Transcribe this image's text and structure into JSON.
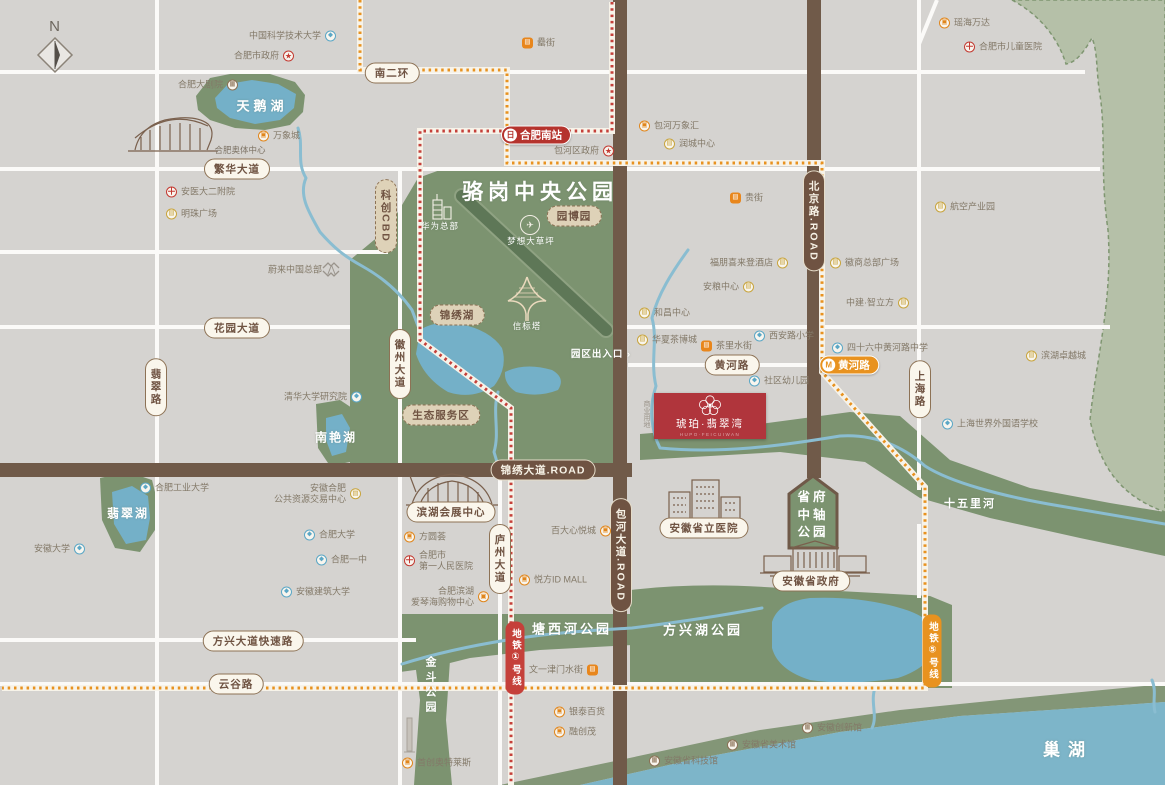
{
  "colors": {
    "background": "#d5d3d0",
    "park_green": "#7c9370",
    "light_green": "#b5c0a8",
    "water_blue": "#74b0c8",
    "river_blue": "#8abdd1",
    "road_brown": "#705a49",
    "metro_line1_red": "#c5403a",
    "metro_line5_orange": "#e8921f",
    "project_red": "#b0353c",
    "station_red": "#b5332d"
  },
  "compass": {
    "label": "N"
  },
  "project": {
    "name": "琥珀·翡翠湾",
    "subtitle": "HUPO·FEICUIWAN"
  },
  "axis_park": {
    "lines": [
      "省府",
      "中轴",
      "公园"
    ]
  },
  "area_labels": [
    {
      "text": "骆岗中央公园",
      "x": 540,
      "y": 191,
      "size": 21,
      "bold": 1,
      "ls": 5
    },
    {
      "text": "园区出入口 ›",
      "x": 601,
      "y": 353,
      "size": 9.5,
      "bold": 1,
      "ls": 1
    },
    {
      "text": "华为总部",
      "x": 440,
      "y": 226,
      "size": 8.5,
      "ls": 1
    },
    {
      "text": "梦想大草坪",
      "x": 531,
      "y": 241,
      "size": 8.5,
      "ls": 1
    },
    {
      "text": "信标塔",
      "x": 527,
      "y": 326,
      "size": 8.5,
      "ls": 1
    },
    {
      "text": "天鹅湖",
      "x": 262,
      "y": 105,
      "size": 13,
      "bold": 1,
      "ls": 4
    },
    {
      "text": "翡翠湖",
      "x": 128,
      "y": 513,
      "size": 12,
      "bold": 1,
      "ls": 2
    },
    {
      "text": "南艳湖",
      "x": 336,
      "y": 437,
      "size": 12,
      "bold": 1,
      "ls": 2
    },
    {
      "text": "金斗公园",
      "x": 430,
      "y": 686,
      "size": 11,
      "bold": 1,
      "ls": 4,
      "vertical": 1
    },
    {
      "text": "塘西河公园",
      "x": 572,
      "y": 628,
      "size": 13,
      "bold": 1,
      "ls": 3
    },
    {
      "text": "方兴湖公园",
      "x": 703,
      "y": 629,
      "size": 13,
      "bold": 1,
      "ls": 3
    },
    {
      "text": "十五里河",
      "x": 970,
      "y": 503,
      "size": 11,
      "bold": 1,
      "ls": 2
    },
    {
      "text": "巢湖",
      "x": 1068,
      "y": 748,
      "size": 17,
      "bold": 1,
      "ls": 8
    },
    {
      "text": "合肥奥体中心",
      "x": 240,
      "y": 150,
      "size": 8.5,
      "color": "#7d7365"
    },
    {
      "text": "商业用地",
      "x": 646,
      "y": 414,
      "size": 7,
      "color": "#9b948a",
      "vertical": 1
    }
  ],
  "pills": [
    {
      "text": "南二环",
      "x": 392,
      "y": 73,
      "style": "cream"
    },
    {
      "text": "繁华大道",
      "x": 237,
      "y": 169,
      "style": "cream"
    },
    {
      "text": "花园大道",
      "x": 237,
      "y": 328,
      "style": "cream"
    },
    {
      "text": "翡翠路",
      "x": 156,
      "y": 387,
      "style": "cream",
      "vertical": 1
    },
    {
      "text": "徽州大道",
      "x": 400,
      "y": 364,
      "style": "cream",
      "vertical": 1
    },
    {
      "text": "黄河路",
      "x": 732,
      "y": 365,
      "style": "cream"
    },
    {
      "text": "上海路",
      "x": 920,
      "y": 389,
      "style": "cream",
      "vertical": 1
    },
    {
      "text": "庐州大道",
      "x": 500,
      "y": 559,
      "style": "cream",
      "vertical": 1
    },
    {
      "text": "方兴大道快速路",
      "x": 253,
      "y": 641,
      "style": "cream"
    },
    {
      "text": "云谷路",
      "x": 236,
      "y": 684,
      "style": "cream"
    },
    {
      "text": "滨湖会展中心",
      "x": 451,
      "y": 512,
      "style": "cream"
    },
    {
      "text": "安徽省立医院",
      "x": 704,
      "y": 528,
      "style": "cream"
    },
    {
      "text": "安徽省政府",
      "x": 811,
      "y": 581,
      "style": "cream"
    },
    {
      "text": "锦绣大道.ROAD",
      "x": 543,
      "y": 470,
      "style": "brown"
    },
    {
      "text": "北京路.ROAD",
      "x": 814,
      "y": 221,
      "style": "brown",
      "vertical": 1
    },
    {
      "text": "包河大道.ROAD",
      "x": 621,
      "y": 555,
      "style": "brown",
      "vertical": 1
    },
    {
      "text": "科创CBD",
      "x": 386,
      "y": 216,
      "style": "tan",
      "vertical": 1
    },
    {
      "text": "园博园",
      "x": 574,
      "y": 216,
      "style": "tan"
    },
    {
      "text": "锦绣湖",
      "x": 457,
      "y": 315,
      "style": "tan"
    },
    {
      "text": "生态服务区",
      "x": 441,
      "y": 415,
      "style": "tan"
    }
  ],
  "stations": [
    {
      "name": "合肥南站",
      "x": 536,
      "y": 135,
      "color": "red",
      "glyph": "日"
    },
    {
      "name": "黄河路",
      "x": 849,
      "y": 365,
      "color": "orange",
      "glyph": "M"
    }
  ],
  "metro_tags": [
    {
      "name": "地铁①号线",
      "x": 515,
      "y": 658,
      "color": "red"
    },
    {
      "name": "地铁⑤号线",
      "x": 932,
      "y": 651,
      "color": "orange"
    }
  ],
  "pois": [
    {
      "t": "school",
      "n": "中国科学技术大学",
      "x": 330,
      "y": 36,
      "side": "left"
    },
    {
      "t": "gov",
      "n": "合肥市政府",
      "x": 288,
      "y": 56,
      "side": "left"
    },
    {
      "t": "street",
      "n": "罍街",
      "x": 528,
      "y": 43,
      "side": "right"
    },
    {
      "t": "mall",
      "n": "瑶海万达",
      "x": 945,
      "y": 23,
      "side": "right"
    },
    {
      "t": "hosp",
      "n": "合肥市儿童医院",
      "x": 970,
      "y": 47,
      "side": "right"
    },
    {
      "t": "museum",
      "n": "合肥大剧院",
      "x": 232,
      "y": 85,
      "side": "left"
    },
    {
      "t": "mall",
      "n": "万象城",
      "x": 264,
      "y": 136,
      "side": "right"
    },
    {
      "t": "hosp",
      "n": "安医大二附院",
      "x": 172,
      "y": 192,
      "side": "right"
    },
    {
      "t": "biz",
      "n": "明珠广场",
      "x": 172,
      "y": 214,
      "side": "right"
    },
    {
      "t": "mall",
      "n": "包河万象汇",
      "x": 645,
      "y": 126,
      "side": "right"
    },
    {
      "t": "biz",
      "n": "润城中心",
      "x": 670,
      "y": 144,
      "side": "right"
    },
    {
      "t": "gov",
      "n": "包河区政府",
      "x": 608,
      "y": 151,
      "side": "left"
    },
    {
      "t": "biz",
      "n": "航空产业园",
      "x": 941,
      "y": 207,
      "side": "right"
    },
    {
      "t": "nio",
      "n": "蔚来中国总部",
      "x": 331,
      "y": 270,
      "side": "left"
    },
    {
      "t": "school",
      "n": "清华大学研究院",
      "x": 356,
      "y": 397,
      "side": "left"
    },
    {
      "t": "street",
      "n": "贵街",
      "x": 736,
      "y": 198,
      "side": "right"
    },
    {
      "t": "biz",
      "n": "福朋喜来登酒店",
      "x": 782,
      "y": 263,
      "side": "left"
    },
    {
      "t": "biz",
      "n": "徽商总部广场",
      "x": 836,
      "y": 263,
      "side": "right"
    },
    {
      "t": "biz",
      "n": "安粮中心",
      "x": 748,
      "y": 287,
      "side": "left"
    },
    {
      "t": "biz",
      "n": "中建·智立方",
      "x": 903,
      "y": 303,
      "side": "left"
    },
    {
      "t": "biz",
      "n": "和昌中心",
      "x": 645,
      "y": 313,
      "side": "right"
    },
    {
      "t": "biz",
      "n": "华夏茶博城",
      "x": 643,
      "y": 340,
      "side": "right"
    },
    {
      "t": "street",
      "n": "茶里水街",
      "x": 707,
      "y": 346,
      "side": "right"
    },
    {
      "t": "school",
      "n": "西安路小学",
      "x": 760,
      "y": 336,
      "side": "right"
    },
    {
      "t": "school",
      "n": "四十六中黄河路中学",
      "x": 838,
      "y": 348,
      "side": "right"
    },
    {
      "t": "school",
      "n": "社区幼儿园",
      "x": 755,
      "y": 381,
      "side": "right"
    },
    {
      "t": "biz",
      "n": "滨湖卓越城",
      "x": 1032,
      "y": 356,
      "side": "right"
    },
    {
      "t": "school",
      "n": "上海世界外国语学校",
      "x": 948,
      "y": 424,
      "side": "right"
    },
    {
      "t": "school",
      "n": "合肥工业大学",
      "x": 146,
      "y": 488,
      "side": "right"
    },
    {
      "t": "school",
      "n": "安徽大学",
      "x": 79,
      "y": 549,
      "side": "left"
    },
    {
      "t": "biz",
      "n": "安徽合肥",
      "n2": "公共资源交易中心",
      "x": 355,
      "y": 494,
      "side": "left"
    },
    {
      "t": "school",
      "n": "合肥大学",
      "x": 310,
      "y": 535,
      "side": "right"
    },
    {
      "t": "school",
      "n": "合肥一中",
      "x": 322,
      "y": 560,
      "side": "right"
    },
    {
      "t": "school",
      "n": "安徽建筑大学",
      "x": 287,
      "y": 592,
      "side": "right"
    },
    {
      "t": "mall",
      "n": "方圆荟",
      "x": 410,
      "y": 537,
      "side": "right"
    },
    {
      "t": "hosp",
      "n": "合肥市",
      "n2": "第一人民医院",
      "x": 410,
      "y": 561,
      "side": "right"
    },
    {
      "t": "mall",
      "n": "合肥滨湖",
      "n2": "爱琴海购物中心",
      "x": 483,
      "y": 597,
      "side": "left"
    },
    {
      "t": "mall",
      "n": "悦方ID MALL",
      "x": 525,
      "y": 580,
      "side": "right"
    },
    {
      "t": "mall",
      "n": "百大心悦城",
      "x": 605,
      "y": 531,
      "side": "left"
    },
    {
      "t": "street",
      "n": "文一津门水街",
      "x": 592,
      "y": 670,
      "side": "left"
    },
    {
      "t": "mall",
      "n": "银泰百货",
      "x": 560,
      "y": 712,
      "side": "right"
    },
    {
      "t": "mall",
      "n": "融创茂",
      "x": 560,
      "y": 732,
      "side": "right"
    },
    {
      "t": "mall",
      "n": "首创奥特莱斯",
      "x": 408,
      "y": 763,
      "side": "right"
    },
    {
      "t": "museum",
      "n": "安徽省科技馆",
      "x": 655,
      "y": 761,
      "side": "right"
    },
    {
      "t": "museum",
      "n": "安徽省美术馆",
      "x": 733,
      "y": 745,
      "side": "right"
    },
    {
      "t": "museum",
      "n": "安徽创新馆",
      "x": 808,
      "y": 728,
      "side": "right"
    }
  ]
}
